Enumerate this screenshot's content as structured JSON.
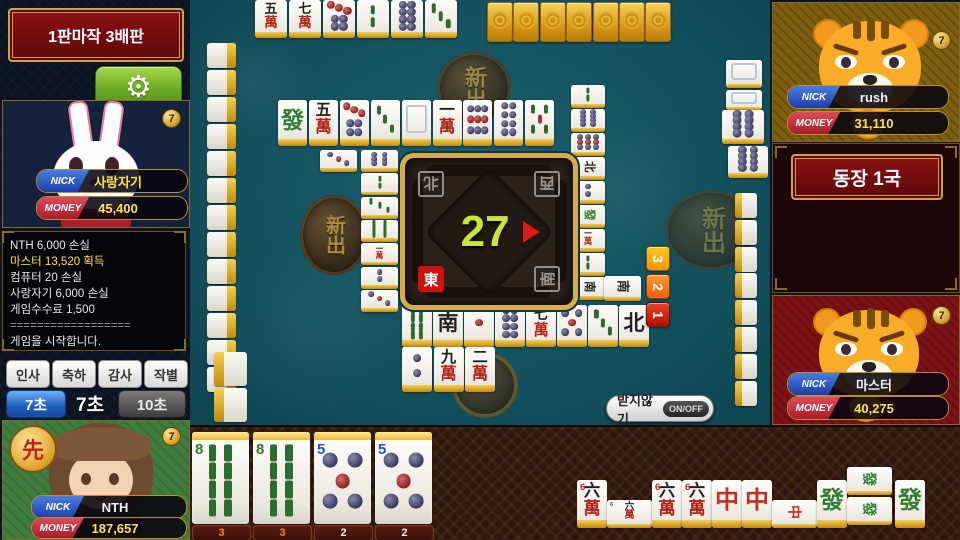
{
  "header": {
    "banner": "1판마작 3배판"
  },
  "settings": {
    "gear_icon": "⚙"
  },
  "players": {
    "west": {
      "nick_label": "NICK",
      "money_label": "MONEY",
      "nick": "사랑자기",
      "money": "45,400",
      "badge": "7"
    },
    "self": {
      "nick_label": "NICK",
      "money_label": "MONEY",
      "nick": "NTH",
      "money": "187,657",
      "badge": "7",
      "seal": "先"
    },
    "north": {
      "nick_label": "NICK",
      "money_label": "MONEY",
      "nick": "rush",
      "money": "31,110",
      "badge": "7"
    },
    "east": {
      "nick_label": "NICK",
      "money_label": "MONEY",
      "nick": "마스터",
      "money": "40,275",
      "badge": "7"
    }
  },
  "log": {
    "lines": [
      {
        "text": "NTH 6,000 손실",
        "color": "white"
      },
      {
        "text": "마스터 13,520 획득",
        "color": "yellow"
      },
      {
        "text": "컴퓨터 20 손실",
        "color": "white"
      },
      {
        "text": "사랑자기 6,000 손실",
        "color": "white"
      },
      {
        "text": "게임수수료 1,500",
        "color": "white"
      },
      {
        "text": "==================",
        "color": "gray"
      },
      {
        "text": "게임을 시작합니다.",
        "color": "white"
      }
    ]
  },
  "chat_buttons": [
    "인사",
    "축하",
    "감사",
    "작별"
  ],
  "timers": {
    "left": "7초",
    "center": "7초",
    "right": "10초"
  },
  "round": {
    "banner": "동장 1국",
    "indicator_tiles": [
      "back",
      "back",
      "F",
      "2m",
      "5s",
      "back",
      "back"
    ]
  },
  "center": {
    "countdown": "27",
    "winds": {
      "top_left": "北",
      "top_right": "西",
      "bottom_left": "東",
      "bottom_right": "南"
    },
    "active_wind": "東"
  },
  "chips": [
    {
      "label": "3",
      "color1": "#ffc822",
      "color2": "#f79400"
    },
    {
      "label": "2",
      "color1": "#ff9838",
      "color2": "#ee5f00"
    },
    {
      "label": "1",
      "color1": "#e84422",
      "color2": "#b31000"
    }
  ],
  "pass_button": {
    "label": "받지않기",
    "toggle": "ON/OFF"
  },
  "table": {
    "top_melds": [
      "5m",
      "7m",
      "7p",
      "2s",
      "8p",
      "3s"
    ],
    "top_hand_backs": 7,
    "top_discards": [
      "F",
      "5m",
      "7p",
      "3s",
      "P",
      "1m",
      "9p",
      "8p",
      "5s"
    ],
    "left_discards_col": [
      "6p",
      "2s",
      "3s",
      "8s",
      "1m",
      "2p",
      "3p"
    ],
    "left_discards_extra": [
      "3p"
    ],
    "right_discards_col": [
      "2s",
      "8p",
      "9p",
      "N",
      "2p",
      "F",
      "1m",
      "2s",
      "S"
    ],
    "right_discards_extra": [
      "S"
    ],
    "bottom_discards_row1": [
      "8s",
      "S",
      "1p",
      "8p",
      "7m",
      "5p",
      "3s",
      "N"
    ],
    "bottom_discards_row2": [
      "2p",
      "9m",
      "2m"
    ],
    "right_melds": [
      "blank",
      "blank",
      "8p",
      "8p"
    ],
    "left_wall_count": 13,
    "right_wall_count": 8,
    "leftover_wall_count": 2,
    "medallion_text": "新出"
  },
  "hand": {
    "tiles": [
      {
        "code": "8s",
        "num": "8",
        "count": "3"
      },
      {
        "code": "8s",
        "num": "8",
        "count": "3"
      },
      {
        "code": "5p",
        "num": "5",
        "count": "2"
      },
      {
        "code": "5p",
        "num": "5",
        "count": "2"
      }
    ],
    "melds": [
      {
        "tiles": [
          "6m",
          "6m",
          "6m",
          "6m"
        ]
      },
      {
        "tiles": [
          "C",
          "C",
          "C"
        ]
      },
      {
        "tiles": [
          "F",
          "F",
          "F",
          "F"
        ]
      }
    ]
  }
}
